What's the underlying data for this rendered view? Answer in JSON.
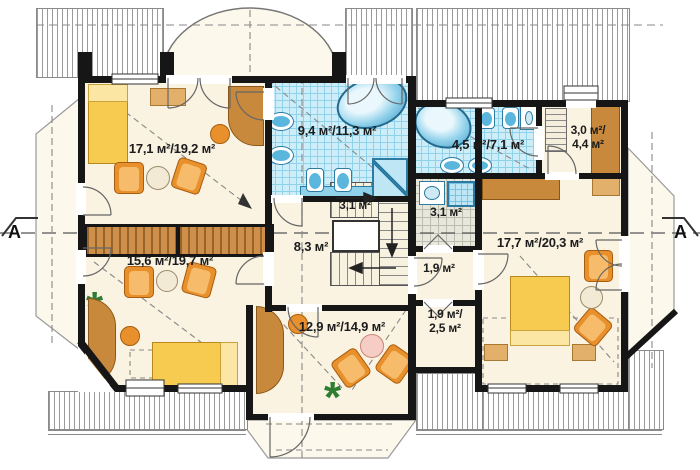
{
  "plan": {
    "type": "attic-floor-plan",
    "section_marker": "A",
    "rooms": [
      {
        "id": "bedroom-top-left",
        "area": "17,1 м²/19,2 м²"
      },
      {
        "id": "bedroom-bottom-left",
        "area": "15,6 м²/19,7 м²"
      },
      {
        "id": "bathroom-main",
        "area": "9,4 м²/11,3 м²"
      },
      {
        "id": "stairs",
        "area": "3,1 м²"
      },
      {
        "id": "hall",
        "area": "8,3 м²"
      },
      {
        "id": "bathroom-second",
        "area": "4,5 м²/7,1 м²"
      },
      {
        "id": "wardrobe",
        "area": "3,0 м²/\n4,4 м²"
      },
      {
        "id": "shower-room",
        "area": "3,1 м²"
      },
      {
        "id": "corridor",
        "area": "1,9 м²"
      },
      {
        "id": "storage",
        "area": "1,9 м²/\n2,5 м²"
      },
      {
        "id": "study",
        "area": "12,9 м²/14,9 м²"
      },
      {
        "id": "bedroom-right",
        "area": "17,7 м²/20,3 м²"
      }
    ],
    "symbols": {
      "plant": "*"
    },
    "colors": {
      "floor": "#faf3e2",
      "bath_tile": "#cdeef9",
      "gray_tile": "#e7e7dd",
      "wall": "#161616",
      "wood": "#c9893d",
      "bed_yellow": "#f6cb50",
      "chair_orange": "#e8912c",
      "fixture_blue": "#5ab6dc",
      "roof_hatch": "#9a9a9a",
      "plant_green": "#2e7d32"
    }
  }
}
